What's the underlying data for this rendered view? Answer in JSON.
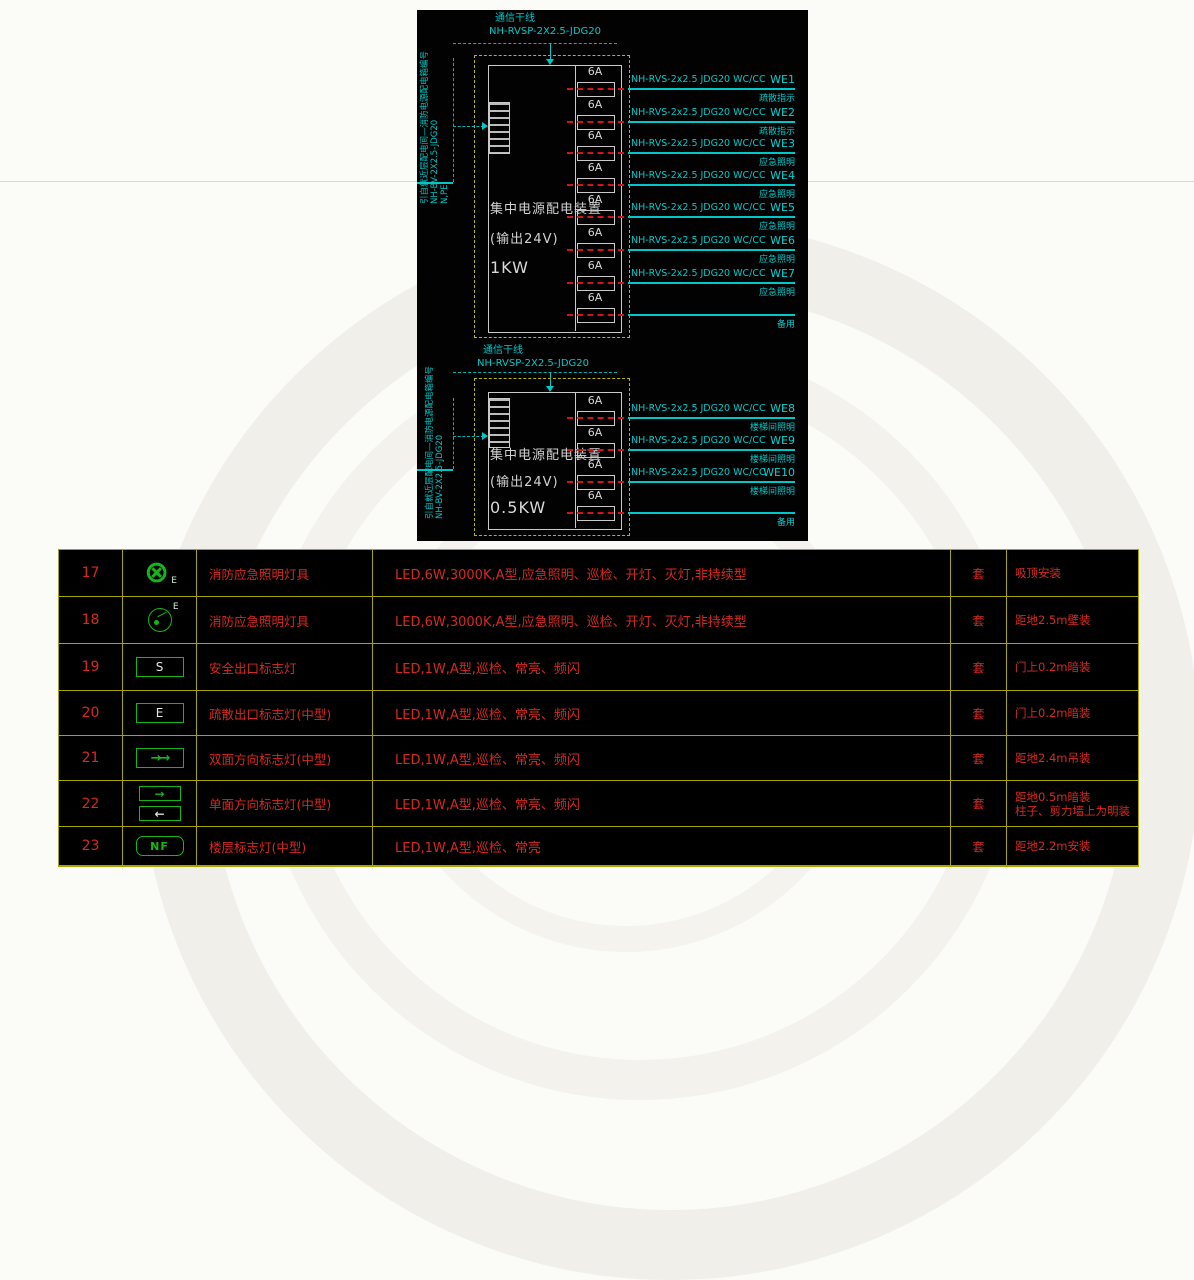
{
  "colors": {
    "cad_background": "#020202",
    "line_cyan": "#00c8c8",
    "box_yellow": "#b8b400",
    "device_white": "#c9c9c9",
    "fuse_red": "#cf1616",
    "table_grid_yellow": "#a7a300",
    "table_text_red": "#d42a22",
    "symbol_green": "#16b616"
  },
  "diagram": {
    "panels": [
      {
        "source_note": "引自就近层配电间—消防电源配电箱编号",
        "source_cable": "NH-BV-2X2.5-JDG20",
        "source_wires": "N,PE",
        "comm_label": "通信干线",
        "comm_cable": "NH-RVSP-2X2.5-JDG20",
        "device_title": "集中电源配电装置",
        "device_output": "(输出24V)",
        "device_power": "1KW",
        "breaker_rating": "6A",
        "circuits": [
          {
            "cable": "NH-RVS-2x2.5 JDG20 WC/CC",
            "id": "WE1",
            "func": "疏散指示"
          },
          {
            "cable": "NH-RVS-2x2.5 JDG20 WC/CC",
            "id": "WE2",
            "func": "疏散指示"
          },
          {
            "cable": "NH-RVS-2x2.5 JDG20 WC/CC",
            "id": "WE3",
            "func": "应急照明"
          },
          {
            "cable": "NH-RVS-2x2.5 JDG20 WC/CC",
            "id": "WE4",
            "func": "应急照明"
          },
          {
            "cable": "NH-RVS-2x2.5 JDG20 WC/CC",
            "id": "WE5",
            "func": "应急照明"
          },
          {
            "cable": "NH-RVS-2x2.5 JDG20 WC/CC",
            "id": "WE6",
            "func": "应急照明"
          },
          {
            "cable": "NH-RVS-2x2.5 JDG20 WC/CC",
            "id": "WE7",
            "func": "应急照明"
          },
          {
            "cable": "",
            "id": "",
            "func": "备用"
          }
        ]
      },
      {
        "source_note": "引自就近层配电间—消防电源配电箱编号",
        "source_cable": "NH-BV-2X2.5-JDG20",
        "source_wires": "",
        "comm_label": "通信干线",
        "comm_cable": "NH-RVSP-2X2.5-JDG20",
        "device_title": "集中电源配电装置",
        "device_output": "(输出24V)",
        "device_power": "0.5KW",
        "breaker_rating": "6A",
        "circuits": [
          {
            "cable": "NH-RVS-2x2.5 JDG20 WC/CC",
            "id": "WE8",
            "func": "楼梯间照明"
          },
          {
            "cable": "NH-RVS-2x2.5 JDG20 WC/CC",
            "id": "WE9",
            "func": "楼梯间照明"
          },
          {
            "cable": "NH-RVS-2x2.5 JDG20 WC/CC",
            "id": "WE10",
            "func": "楼梯间照明"
          },
          {
            "cable": "",
            "id": "",
            "func": "备用"
          }
        ]
      }
    ]
  },
  "legend_table": {
    "rows": [
      {
        "no": "17",
        "icon": {
          "name": "ceiling-fire-emergency-light-icon",
          "type": "circle-x",
          "glyph": "⊗",
          "label": "E"
        },
        "name": "消防应急照明灯具",
        "desc": "LED,6W,3000K,A型,应急照明、巡检、开灯、灭灯,非持续型",
        "qty": "套",
        "install": "吸顶安装"
      },
      {
        "no": "18",
        "icon": {
          "name": "wall-fire-emergency-light-icon",
          "type": "circle-spot",
          "label": "E"
        },
        "name": "消防应急照明灯具",
        "desc": "LED,6W,3000K,A型,应急照明、巡检、开灯、灭灯,非持续型",
        "qty": "套",
        "install": "距地2.5m壁装"
      },
      {
        "no": "19",
        "icon": {
          "name": "safety-exit-sign-icon",
          "type": "box-letter",
          "letter": "S"
        },
        "name": "安全出口标志灯",
        "desc": "LED,1W,A型,巡检、常亮、频闪",
        "qty": "套",
        "install": "门上0.2m暗装"
      },
      {
        "no": "20",
        "icon": {
          "name": "evacuation-exit-sign-icon",
          "type": "box-letter",
          "letter": "E"
        },
        "name": "疏散出口标志灯(中型)",
        "desc": "LED,1W,A型,巡检、常亮、频闪",
        "qty": "套",
        "install": "门上0.2m暗装"
      },
      {
        "no": "21",
        "icon": {
          "name": "double-sided-direction-sign-icon",
          "type": "box-arrows",
          "glyph": "→→"
        },
        "name": "双面方向标志灯(中型)",
        "desc": "LED,1W,A型,巡检、常亮、频闪",
        "qty": "套",
        "install": "距地2.4m吊装"
      },
      {
        "no": "22",
        "icon": {
          "name": "single-sided-direction-sign-icon",
          "type": "box-arrows-2",
          "glyphs": [
            "→",
            "←"
          ]
        },
        "name": "单面方向标志灯(中型)",
        "desc": "LED,1W,A型,巡检、常亮、频闪",
        "qty": "套",
        "install": "距地0.5m暗装\n柱子、剪力墙上为明装"
      },
      {
        "no": "23",
        "icon": {
          "name": "floor-indicator-sign-icon",
          "type": "box-text",
          "text": "NF"
        },
        "name": "楼层标志灯(中型)",
        "desc": "LED,1W,A型,巡检、常亮",
        "qty": "套",
        "install": "距地2.2m安装"
      }
    ]
  }
}
